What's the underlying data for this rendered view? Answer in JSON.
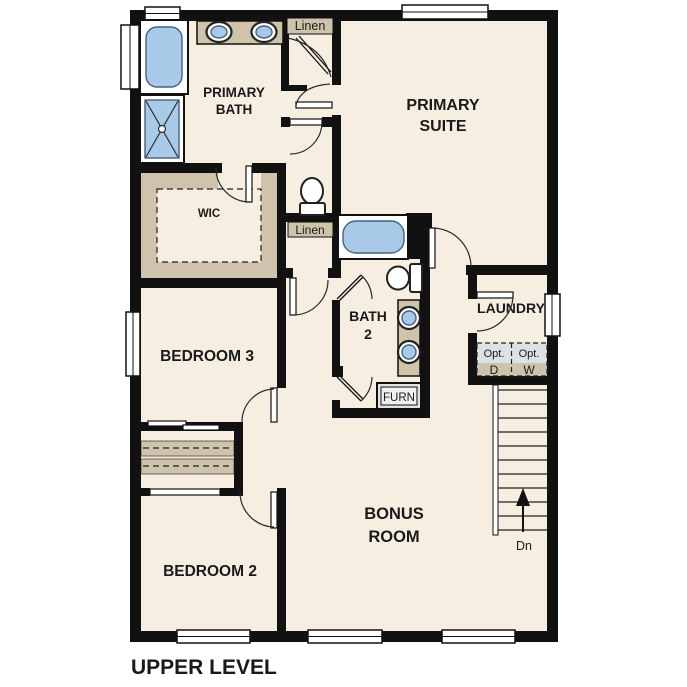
{
  "title": "UPPER LEVEL",
  "colors": {
    "wall": "#111111",
    "floor": "#f5eee1",
    "tan": "#cfc3ab",
    "fixture-blue": "#a9c9e9",
    "opt-gray": "#dce1e6",
    "equip-gray": "#e3e3e3"
  },
  "rooms": {
    "primary_bath": {
      "line1": "PRIMARY",
      "line2": "BATH"
    },
    "primary_suite": {
      "line1": "PRIMARY",
      "line2": "SUITE"
    },
    "wic": {
      "label": "WIC"
    },
    "bedroom3": {
      "label": "BEDROOM 3"
    },
    "bath2": {
      "line1": "BATH",
      "line2": "2"
    },
    "laundry": {
      "label": "LAUNDRY"
    },
    "bedroom2": {
      "label": "BEDROOM 2"
    },
    "bonus_room": {
      "line1": "BONUS",
      "line2": "ROOM"
    }
  },
  "closets": {
    "linen_upper": {
      "label": "Linen"
    },
    "linen_hall": {
      "label": "Linen"
    }
  },
  "laundry_appliances": {
    "dryer": {
      "qualifier": "Opt.",
      "letter": "D"
    },
    "washer": {
      "qualifier": "Opt.",
      "letter": "W"
    }
  },
  "equipment": {
    "furnace": {
      "label": "FURN"
    }
  },
  "stairs": {
    "direction_label": "Dn"
  }
}
